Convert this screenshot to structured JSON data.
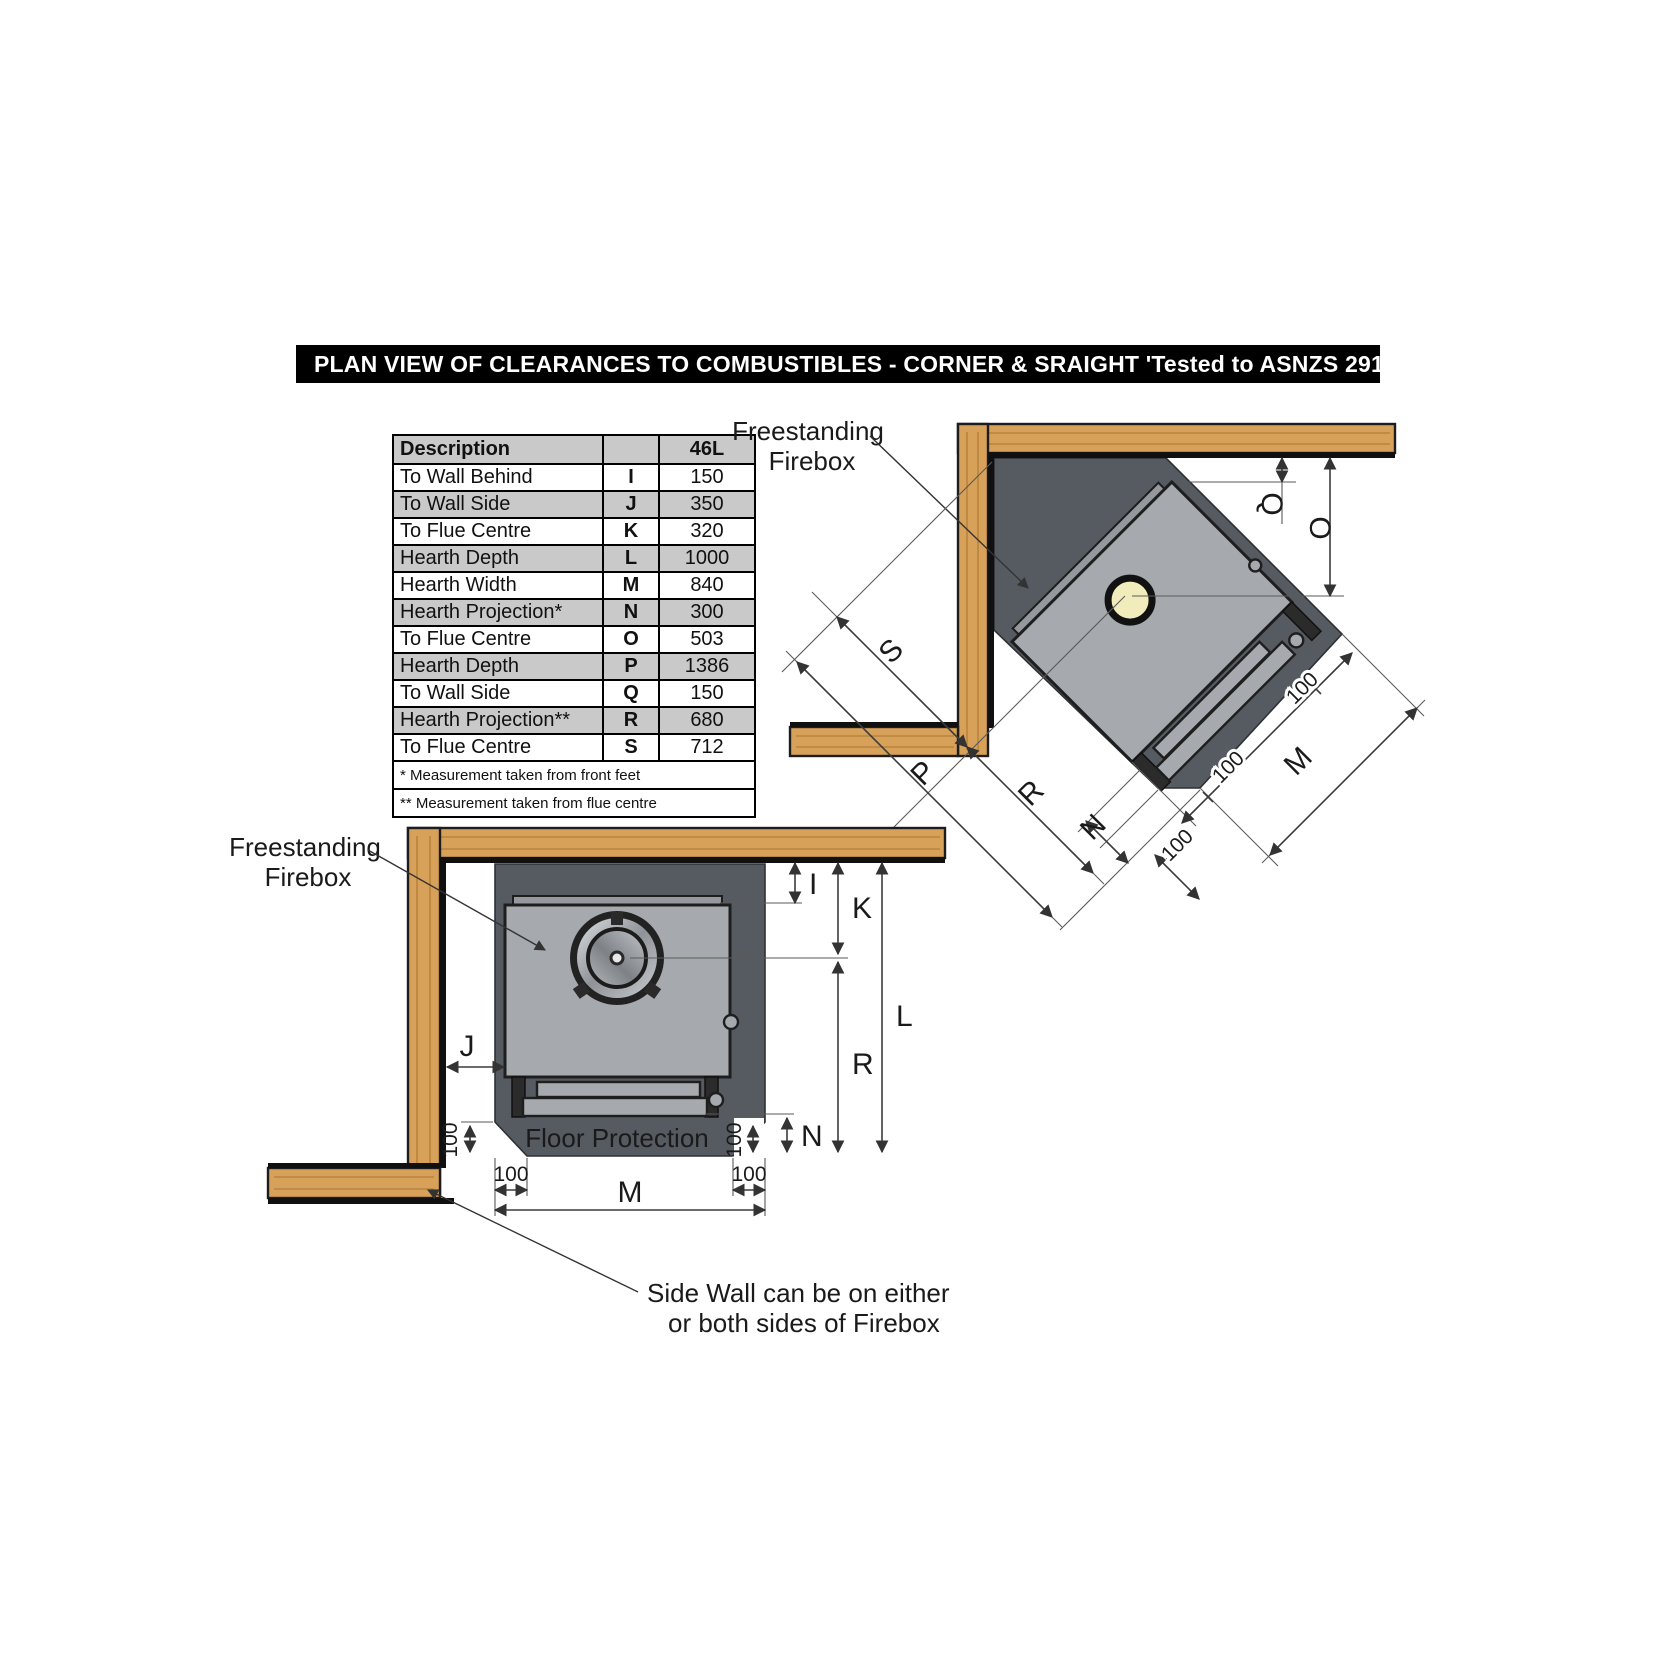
{
  "title": "PLAN VIEW OF CLEARANCES TO COMBUSTIBLES  - CORNER & SRAIGHT 'Tested to ASNZS 2918'",
  "table": {
    "header": {
      "description": "Description",
      "code": "",
      "value": "46L"
    },
    "rows": [
      {
        "description": "To Wall Behind",
        "code": "I",
        "value": "150"
      },
      {
        "description": "To Wall Side",
        "code": "J",
        "value": "350"
      },
      {
        "description": "To Flue Centre",
        "code": "K",
        "value": "320"
      },
      {
        "description": "Hearth Depth",
        "code": "L",
        "value": "1000"
      },
      {
        "description": "Hearth Width",
        "code": "M",
        "value": "840"
      },
      {
        "description": "Hearth Projection*",
        "code": "N",
        "value": "300"
      },
      {
        "description": "To Flue Centre",
        "code": "O",
        "value": "503"
      },
      {
        "description": "Hearth Depth",
        "code": "P",
        "value": "1386"
      },
      {
        "description": "To Wall Side",
        "code": "Q",
        "value": "150"
      },
      {
        "description": "Hearth Projection**",
        "code": "R",
        "value": "680"
      },
      {
        "description": "To Flue Centre",
        "code": "S",
        "value": "712"
      }
    ],
    "footnotes": [
      "* Measurement taken from front feet",
      "** Measurement taken from flue centre"
    ]
  },
  "corner": {
    "firebox_label_line1": "Freestanding",
    "firebox_label_line2": "Firebox",
    "dims": {
      "q": "Q",
      "o": "O",
      "s": "S",
      "p": "P",
      "r": "R",
      "n": "N",
      "m": "M",
      "hundred": "100"
    }
  },
  "straight": {
    "firebox_label_line1": "Freestanding",
    "firebox_label_line2": "Firebox",
    "floor_label": "Floor Protection",
    "note_line1": "Side Wall can be on either",
    "note_line2": "or both sides of Firebox",
    "dims": {
      "i": "I",
      "j": "J",
      "k": "K",
      "l": "L",
      "r": "R",
      "n": "N",
      "m": "M",
      "hundred": "100"
    }
  },
  "colors": {
    "title_bg": "#000000",
    "title_fg": "#ffffff",
    "wood": "#d7a159",
    "wood_grain": "#b5813a",
    "hearth": "#565b61",
    "firebox": "#a6a9ad",
    "flue_corner": "#f2ecbc",
    "table_shade": "#c9c9c9"
  }
}
